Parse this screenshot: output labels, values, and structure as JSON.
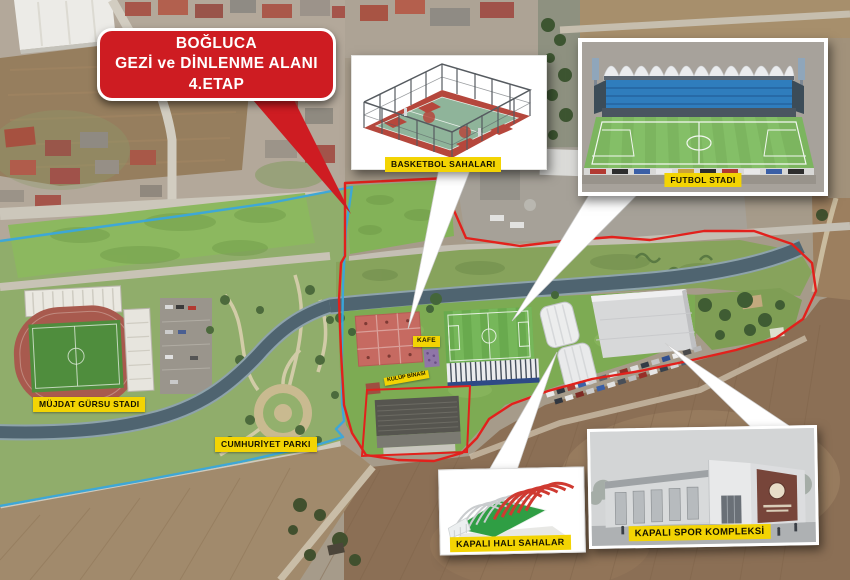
{
  "colors": {
    "callout-red": "#ce1c22",
    "boundary-red": "#e2211c",
    "boundary-blue": "#3aa7dc",
    "label-yellow": "#f3d403",
    "label-text": "#161300"
  },
  "callout": {
    "line1": "BOĞLUCA",
    "line2": "GEZİ ve DİNLENME ALANI",
    "line3": "4.ETAP"
  },
  "insets": {
    "basketball": {
      "label": "BASKETBOL SAHALARI"
    },
    "stadium": {
      "label": "FUTBOL STADI"
    },
    "indoor_turf": {
      "label": "KAPALI HALI SAHALAR"
    },
    "sports_complex": {
      "label": "KAPALI SPOR KOMPLEKSİ"
    }
  },
  "map_labels": {
    "stadium_existing": "MÜJDAT GÜRSU STADI",
    "park": "CUMHURİYET PARKI",
    "cafe": "KAFE",
    "club_building": "KULÜP BİNASI"
  }
}
